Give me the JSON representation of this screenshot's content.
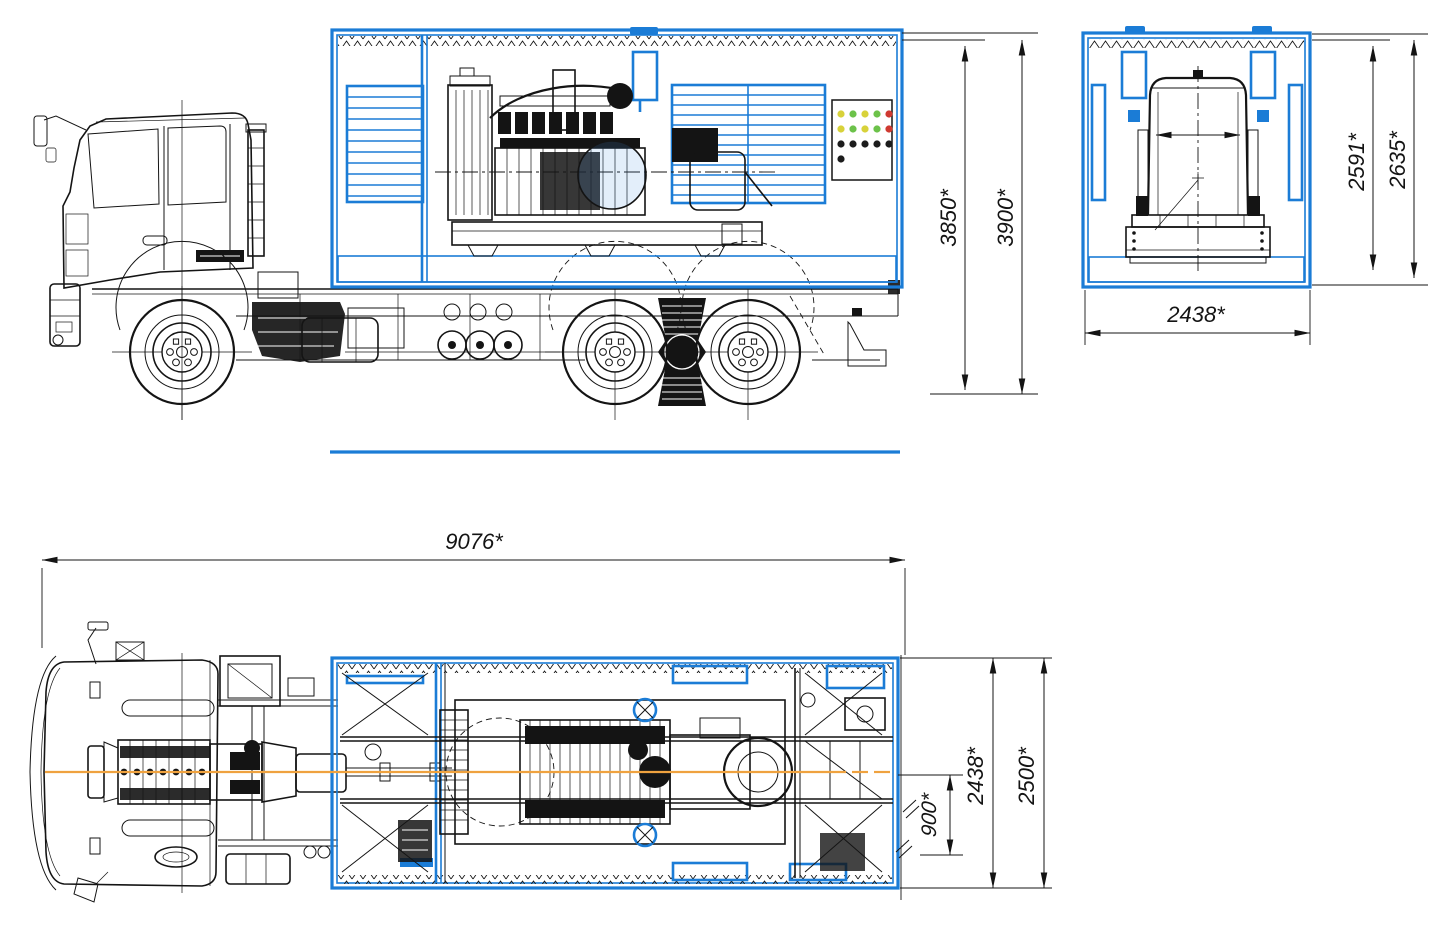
{
  "drawing": {
    "colors": {
      "frame_blue": "#1b7cd6",
      "ink": "#141414",
      "centerline_orange": "#efa23f",
      "paper": "#ffffff"
    }
  },
  "dimensions": {
    "side_container_height": {
      "label": "3850*"
    },
    "side_overall_height": {
      "label": "3900*"
    },
    "rear_container_height": {
      "label": "2591*"
    },
    "rear_overall_height": {
      "label": "2635*"
    },
    "rear_width": {
      "label": "2438*"
    },
    "plan_overall_length": {
      "label": "9076*"
    },
    "plan_container_width": {
      "label": "2438*"
    },
    "plan_overall_width": {
      "label": "2500*"
    },
    "plan_axis_offset": {
      "label": "900*"
    }
  },
  "control_panel": {
    "palette": {
      "yellow": "#d8d23a",
      "green": "#6cc24a",
      "red": "#cf3a31",
      "black": "#1c1c1c"
    },
    "rows": [
      [
        "yellow",
        "green",
        "yellow",
        "green",
        "red"
      ],
      [
        "yellow",
        "green",
        "yellow",
        "green",
        "red"
      ],
      [
        "black",
        "black",
        "black",
        "black",
        "black"
      ]
    ],
    "extra_dot": "black"
  }
}
